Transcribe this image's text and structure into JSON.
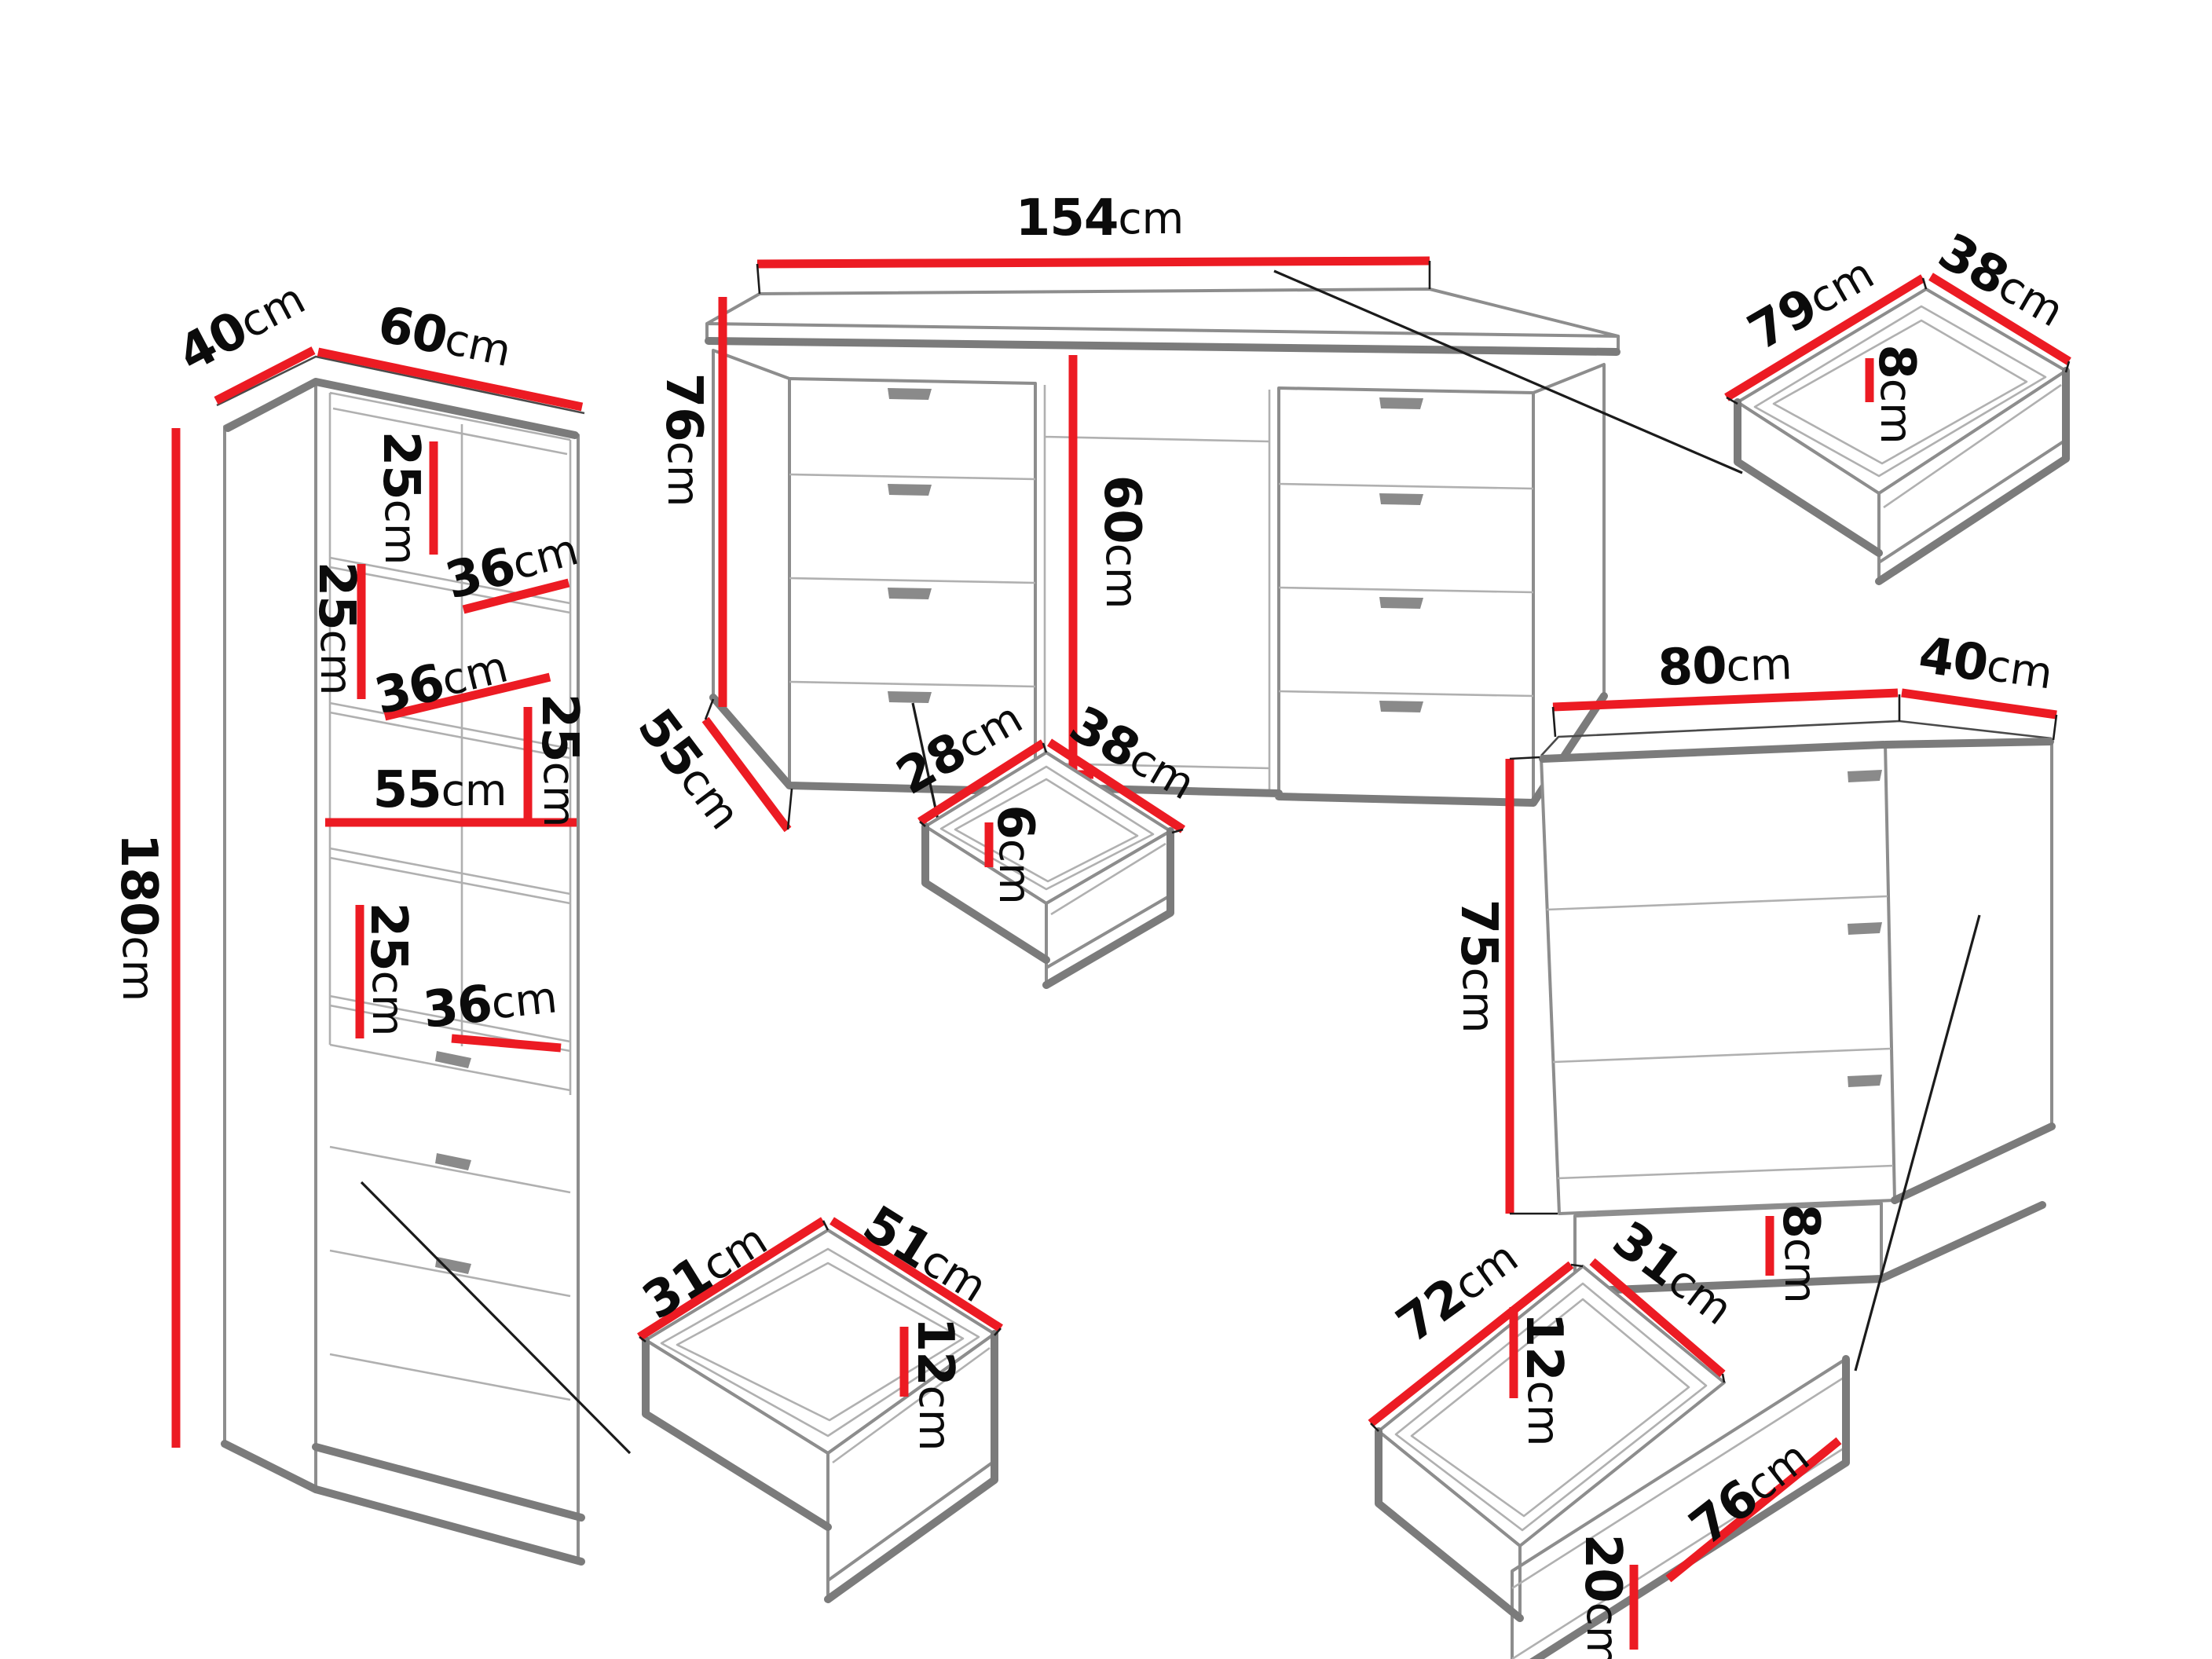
{
  "diagram": {
    "type": "furniture-dimensions-diagram",
    "unit": "cm",
    "colors": {
      "background": "#ffffff",
      "dimension_red": "#EC1B23",
      "outline_gray": "#7b7b7b",
      "detail_gray": "#9a9a9a",
      "text_black": "#0b0b0b"
    },
    "pieces": {
      "bookcase": {
        "name": "tall-bookcase-with-drawers",
        "labels": {
          "depth": {
            "v": "40",
            "u": "cm"
          },
          "width": {
            "v": "60",
            "u": "cm"
          },
          "height": {
            "v": "180",
            "u": "cm"
          },
          "gap1": {
            "v": "25",
            "u": "cm"
          },
          "shelf1": {
            "v": "36",
            "u": "cm"
          },
          "gap2": {
            "v": "25",
            "u": "cm"
          },
          "shelf2": {
            "v": "36",
            "u": "cm"
          },
          "gap3": {
            "v": "25",
            "u": "cm"
          },
          "inner_width": {
            "v": "55",
            "u": "cm"
          },
          "gap4": {
            "v": "25",
            "u": "cm"
          },
          "shelf3": {
            "v": "36",
            "u": "cm"
          }
        }
      },
      "desk": {
        "name": "desk-with-two-pedestals",
        "labels": {
          "width": {
            "v": "154",
            "u": "cm"
          },
          "height": {
            "v": "76",
            "u": "cm"
          },
          "depth": {
            "v": "55",
            "u": "cm"
          },
          "opening_height": {
            "v": "60",
            "u": "cm"
          }
        }
      },
      "desk_drawer": {
        "name": "desk-drawer-box",
        "labels": {
          "depth": {
            "v": "79",
            "u": "cm"
          },
          "width": {
            "v": "38",
            "u": "cm"
          },
          "inner_height": {
            "v": "8",
            "u": "cm"
          }
        }
      },
      "small_drawer": {
        "name": "small-drawer-box",
        "labels": {
          "depth": {
            "v": "28",
            "u": "cm"
          },
          "width": {
            "v": "38",
            "u": "cm"
          },
          "inner_height": {
            "v": "6",
            "u": "cm"
          }
        }
      },
      "chest": {
        "name": "chest-of-drawers",
        "labels": {
          "width": {
            "v": "80",
            "u": "cm"
          },
          "depth": {
            "v": "40",
            "u": "cm"
          },
          "height": {
            "v": "75",
            "u": "cm"
          },
          "plinth_height": {
            "v": "8",
            "u": "cm"
          }
        }
      },
      "center_drawer": {
        "name": "bookcase-drawer-box",
        "labels": {
          "depth": {
            "v": "31",
            "u": "cm"
          },
          "width": {
            "v": "51",
            "u": "cm"
          },
          "inner_height": {
            "v": "12",
            "u": "cm"
          }
        }
      },
      "chest_drawer": {
        "name": "chest-drawer-box",
        "labels": {
          "depth": {
            "v": "72",
            "u": "cm"
          },
          "width": {
            "v": "31",
            "u": "cm"
          },
          "inner_height": {
            "v": "12",
            "u": "cm"
          },
          "front_height": {
            "v": "20",
            "u": "cm"
          },
          "front_width": {
            "v": "76",
            "u": "cm"
          }
        }
      }
    }
  }
}
